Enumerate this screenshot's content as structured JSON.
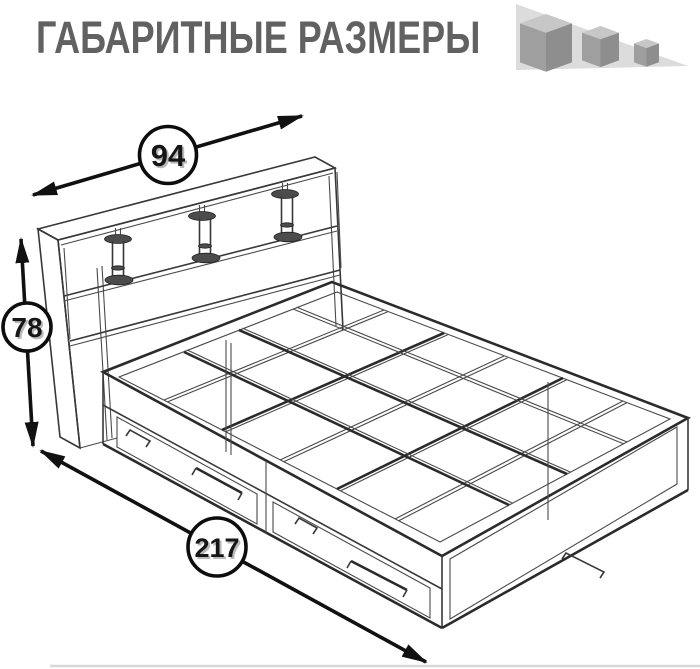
{
  "header": {
    "title": "ГАБАРИТНЫЕ РАЗМЕРЫ"
  },
  "logo": {
    "icon": "three-descending-cubes-on-slope"
  },
  "diagram": {
    "subject": "bed-with-underbed-drawers-wireframe",
    "view": "isometric",
    "dimensions": {
      "width": {
        "value": "94",
        "arrow": "diagonal-top-left"
      },
      "height": {
        "value": "78",
        "arrow": "vertical-left"
      },
      "length": {
        "value": "217",
        "arrow": "diagonal-bottom-left"
      }
    }
  },
  "colors": {
    "background": "#ffffff",
    "title_text": "#616161",
    "drawing_line": "#3a3a3a",
    "arrow": "#111111",
    "dimension_text": "#161616",
    "dimension_text_shadow": "#b9b9b9",
    "logo_triangle": "#dcdcdc",
    "logo_cube_top": "#c7c7c7",
    "logo_cube_left": "#9f9f9f",
    "logo_cube_right": "#8e8e8e",
    "bottom_edge_line": "#d9d9d9"
  }
}
